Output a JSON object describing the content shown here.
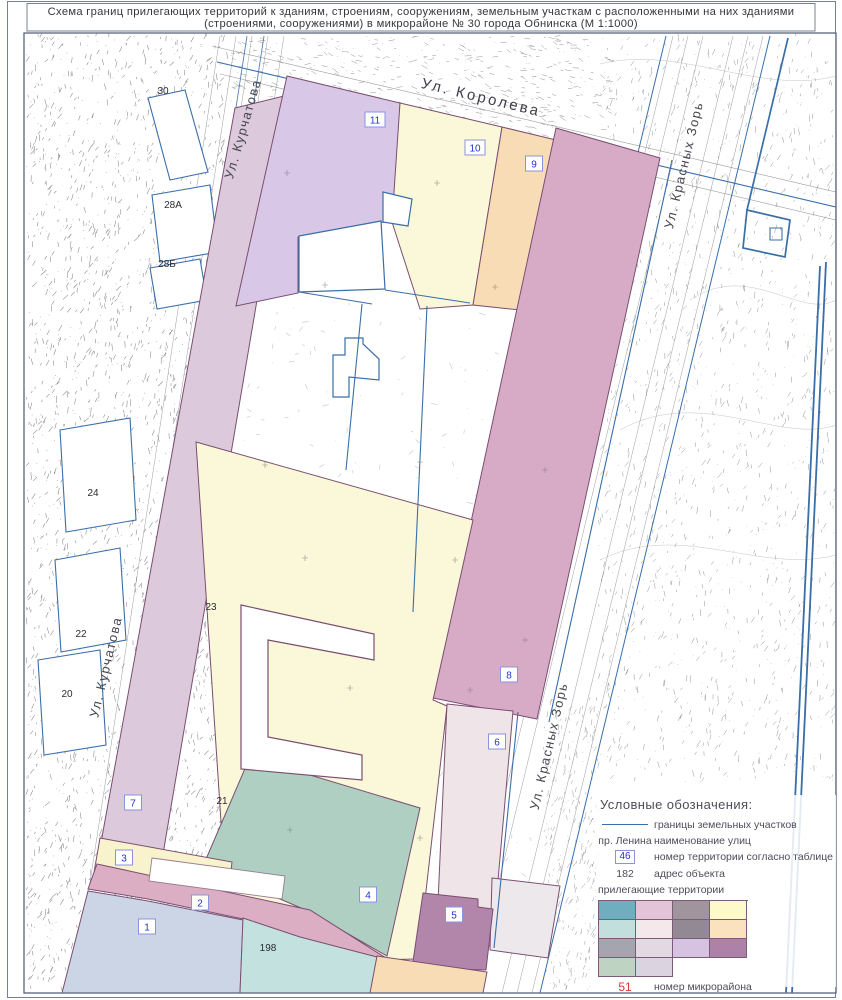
{
  "title": {
    "line1": "Схема границ прилегающих территорий к зданиям, строениям, сооружениям, земельным участкам с расположенными на них зданиями",
    "line2": "(строениями, сооружениями) в микрорайоне № 30  города Обнинска (М 1:1000)"
  },
  "map": {
    "streets": {
      "koroleva": "Ул. Королева",
      "kurchatova": "Ул. Курчатова",
      "krasnykh_zor": "Ул. Красных Зорь"
    },
    "territory_numbers": {
      "t1": "1",
      "t2": "2",
      "t3": "3",
      "t4": "4",
      "t5": "5",
      "t6": "6",
      "t7": "7",
      "t8": "8",
      "t9": "9",
      "t10": "10",
      "t11": "11"
    },
    "addresses": {
      "a30": "30",
      "a28a": "28А",
      "a28b": "28Б",
      "a24": "24",
      "a22": "22",
      "a20": "20",
      "a23": "23",
      "a21": "21",
      "a198": "198"
    }
  },
  "legend": {
    "heading": "Условные обозначения:",
    "items": {
      "boundaries": "границы земельных участков",
      "street_example": "пр. Ленина",
      "street_name": "наименование улиц",
      "territory_number_example": "46",
      "territory_number": "номер территории согласно таблице",
      "address_example": "182",
      "address": "адрес объекта",
      "adjacent": "прилегающие территории",
      "district_number_example": "51",
      "district_number": "номер микрорайона"
    },
    "swatches": [
      "#6FAEBE",
      "#E3C3D8",
      "#A0959C",
      "#FCF9CB",
      "#C2DEDD",
      "#F4E8EA",
      "#938995",
      "#FAE2BE",
      "#A5A5B0",
      "#E2D9E3",
      "#D6C3E1",
      "#AE82A8",
      "#BFD3C2",
      "#DBD3E0"
    ],
    "colors": {
      "boundary_line": "#3a6ea8",
      "territory_number_blue": "#2433cc",
      "district_number_red": "#e03535"
    }
  }
}
